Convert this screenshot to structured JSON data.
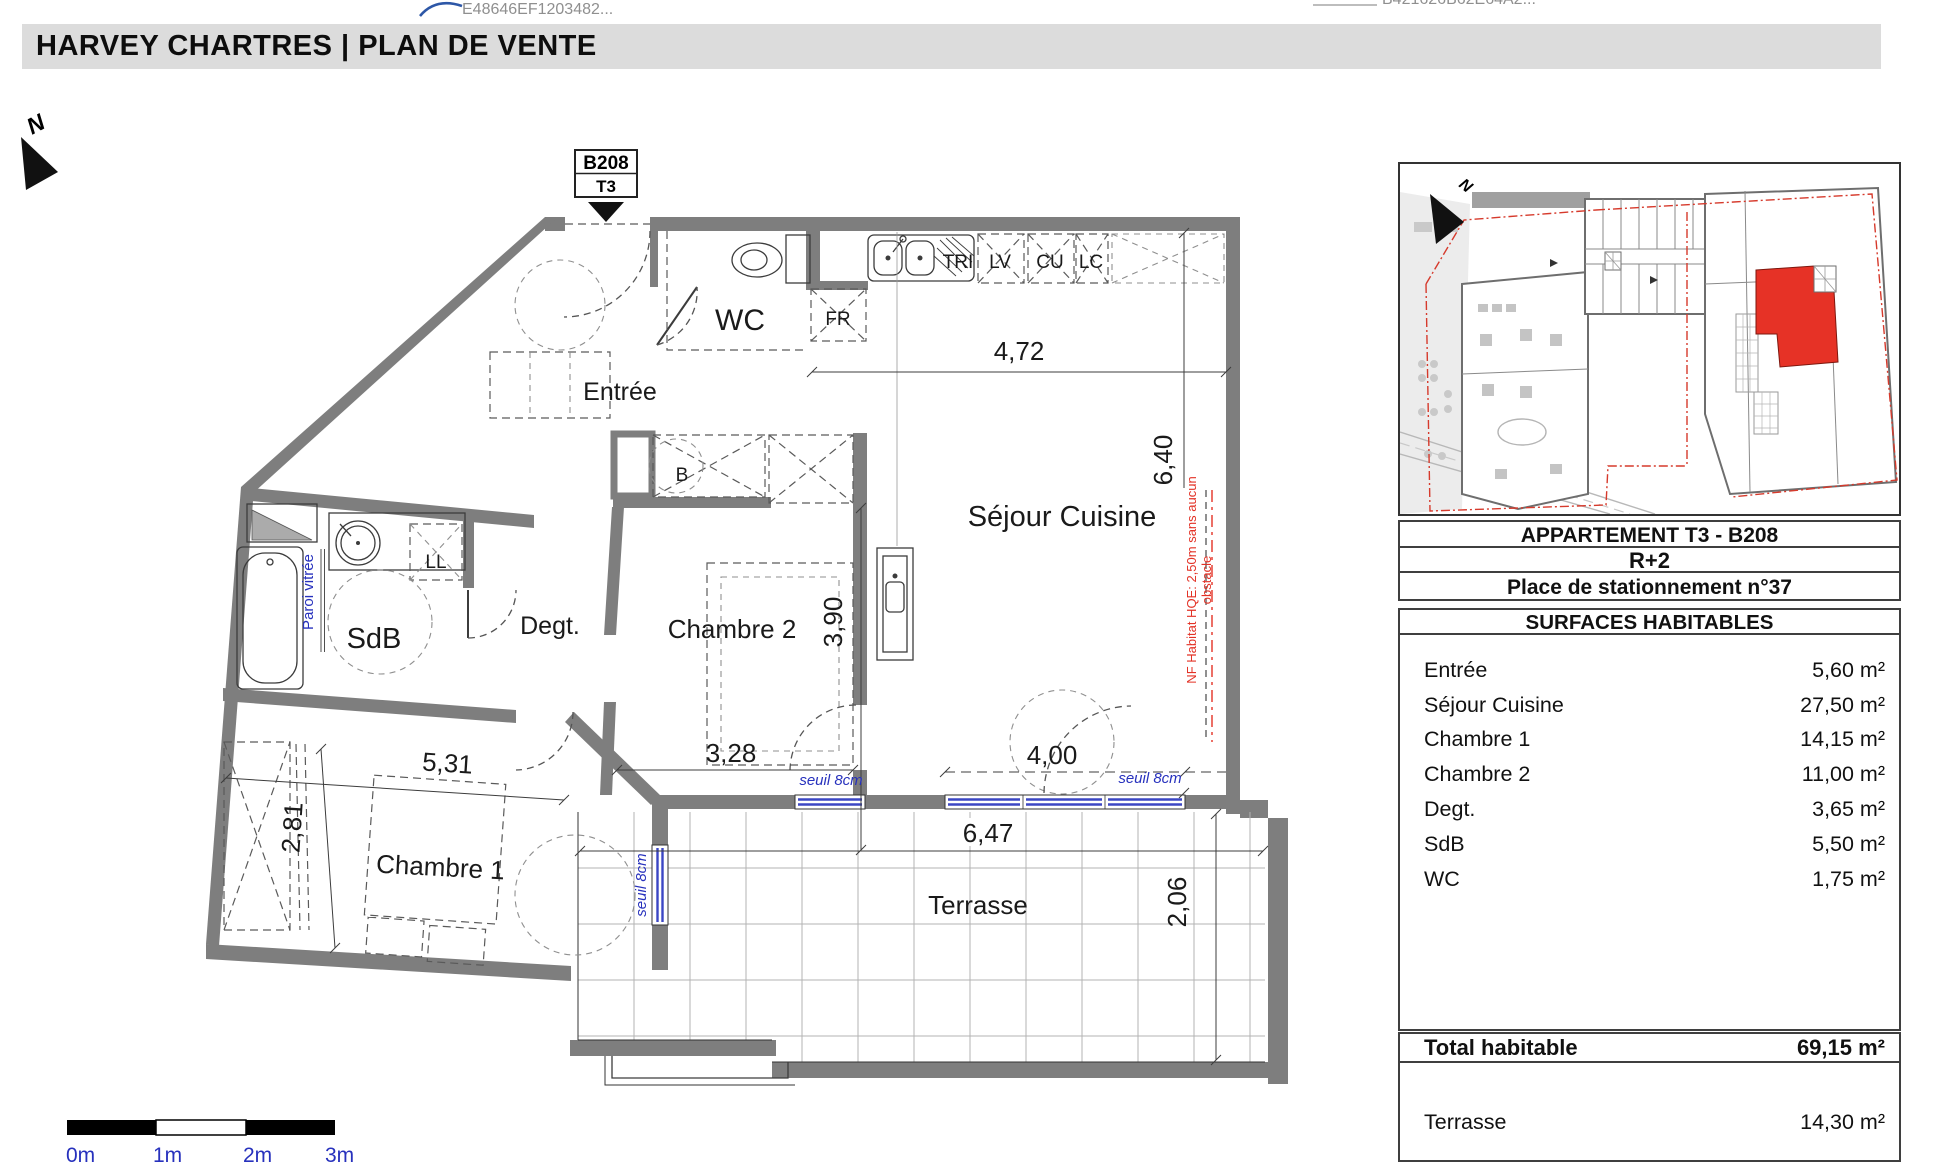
{
  "stamps": {
    "left_code": "E48646EF1203482...",
    "right_code": "B421626B62E64A2..."
  },
  "header": {
    "title": "HARVEY CHARTRES | PLAN DE VENTE"
  },
  "plan": {
    "marker": {
      "unit": "B208",
      "type": "T3"
    },
    "north": "N",
    "labels": {
      "wc": "WC",
      "entree": "Entrée",
      "sejour": "Séjour Cuisine",
      "sdb": "SdB",
      "degt": "Degt.",
      "chambre2": "Chambre 2",
      "chambre1": "Chambre 1",
      "terrasse": "Terrasse",
      "b": "B",
      "ll": "LL",
      "fr": "FR",
      "tri": "TRI",
      "lv": "LV",
      "cu": "CU",
      "lc": "LC"
    },
    "dims": {
      "d472": "4,72",
      "d640": "6,40",
      "d390": "3,90",
      "d328": "3,28",
      "d400": "4,00",
      "d531": "5,31",
      "d281": "2,81",
      "d647": "6,47",
      "d206": "2,06"
    },
    "notes": {
      "paroi": "Paroi vitrée",
      "seuil1": "seuil 8cm",
      "seuil2": "seuil 8cm",
      "seuil3": "seuil 8cm",
      "nf1": "NF Habitat HQE: 2,50m sans aucun",
      "nf2": "obstacle"
    },
    "scale": {
      "m0": "0m",
      "m1": "1m",
      "m2": "2m",
      "m3": "3m"
    }
  },
  "sitemap": {
    "north": "N"
  },
  "panel": {
    "title": "APPARTEMENT  T3  -  B208",
    "floor": "R+2",
    "parking": "Place de stationnement n°37",
    "surfaces_title": "SURFACES HABITABLES",
    "rows": [
      {
        "label": "Entrée",
        "value": "5,60 m²"
      },
      {
        "label": "Séjour Cuisine",
        "value": "27,50 m²"
      },
      {
        "label": "Chambre 1",
        "value": "14,15 m²"
      },
      {
        "label": "Chambre 2",
        "value": "11,00 m²"
      },
      {
        "label": "Degt.",
        "value": "3,65 m²"
      },
      {
        "label": "SdB",
        "value": "5,50 m²"
      },
      {
        "label": "WC",
        "value": "1,75 m²"
      }
    ],
    "total": {
      "label": "Total habitable",
      "value": "69,15 m²"
    },
    "terrace": {
      "label": "Terrasse",
      "value": "14,30 m²"
    }
  }
}
